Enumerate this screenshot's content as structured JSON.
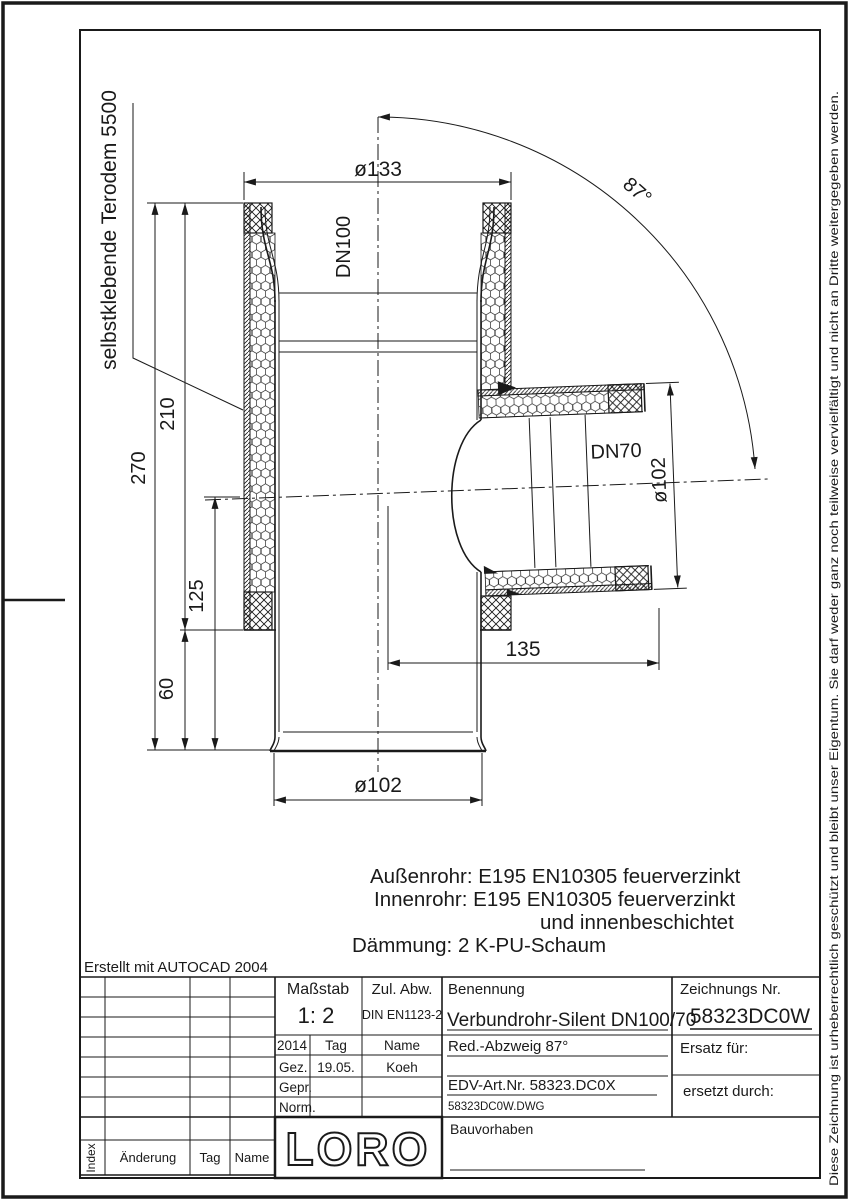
{
  "colors": {
    "ink": "#1a1a1a",
    "paper": "#ffffff"
  },
  "sheet": {
    "erstellt_note": "Erstellt mit AUTOCAD 2004",
    "copyright_note": "Diese Zeichnung ist urheberrechtlich geschützt und bleibt unser Eigentum. Sie darf weder ganz noch teilweise vervielfältigt und nicht an Dritte weitergegeben werden."
  },
  "drawing": {
    "insulation_label": "selbstklebende Terodem 5500",
    "main_pipe_label": "DN100",
    "branch_pipe_label": "DN70",
    "dim_top_diameter": "ø133",
    "dim_branch_angle": "87°",
    "dim_total_height": "270",
    "dim_insulated_height": "210",
    "dim_branch_center_to_end": "125",
    "dim_spigot_length": "60",
    "dim_branch_length": "135",
    "dim_branch_outer_diameter": "ø102",
    "dim_bottom_diameter": "ø102",
    "notes": [
      "Außenrohr:  E195 EN10305 feuerverzinkt",
      "Innenrohr:  E195 EN10305 feuerverzinkt",
      "und innenbeschichtet",
      "Dämmung:  2 K-PU-Schaum"
    ]
  },
  "titleblock": {
    "masstab_label": "Maßstab",
    "masstab_value": "1: 2",
    "zul_abw_label": "Zul. Abw.",
    "zul_abw_value": "DIN EN1123-2",
    "benennung_label": "Benennung",
    "benennung_value": "Verbundrohr-Silent DN100/70",
    "subtitle": "Red.-Abzweig 87°",
    "edv_value": "EDV-Art.Nr.  58323.DC0X",
    "dwg_value": "58323DC0W.DWG",
    "zeichnungs_label": "Zeichnungs Nr.",
    "zeichnungs_value": "58323DC0W",
    "ersatz_label": "Ersatz für:",
    "ersetzt_label": "ersetzt durch:",
    "year": "2014",
    "tag_label": "Tag",
    "name_label": "Name",
    "gez_label": "Gez.",
    "gez_tag": "19.05.",
    "gez_name": "Koeh",
    "gepr_label": "Gepr.",
    "norm_label": "Norm.",
    "index_label": "Index",
    "aenderung_label": "Änderung",
    "tag2_label": "Tag",
    "name2_label": "Name",
    "logo": "LORO",
    "bauvorhaben_label": "Bauvorhaben"
  }
}
